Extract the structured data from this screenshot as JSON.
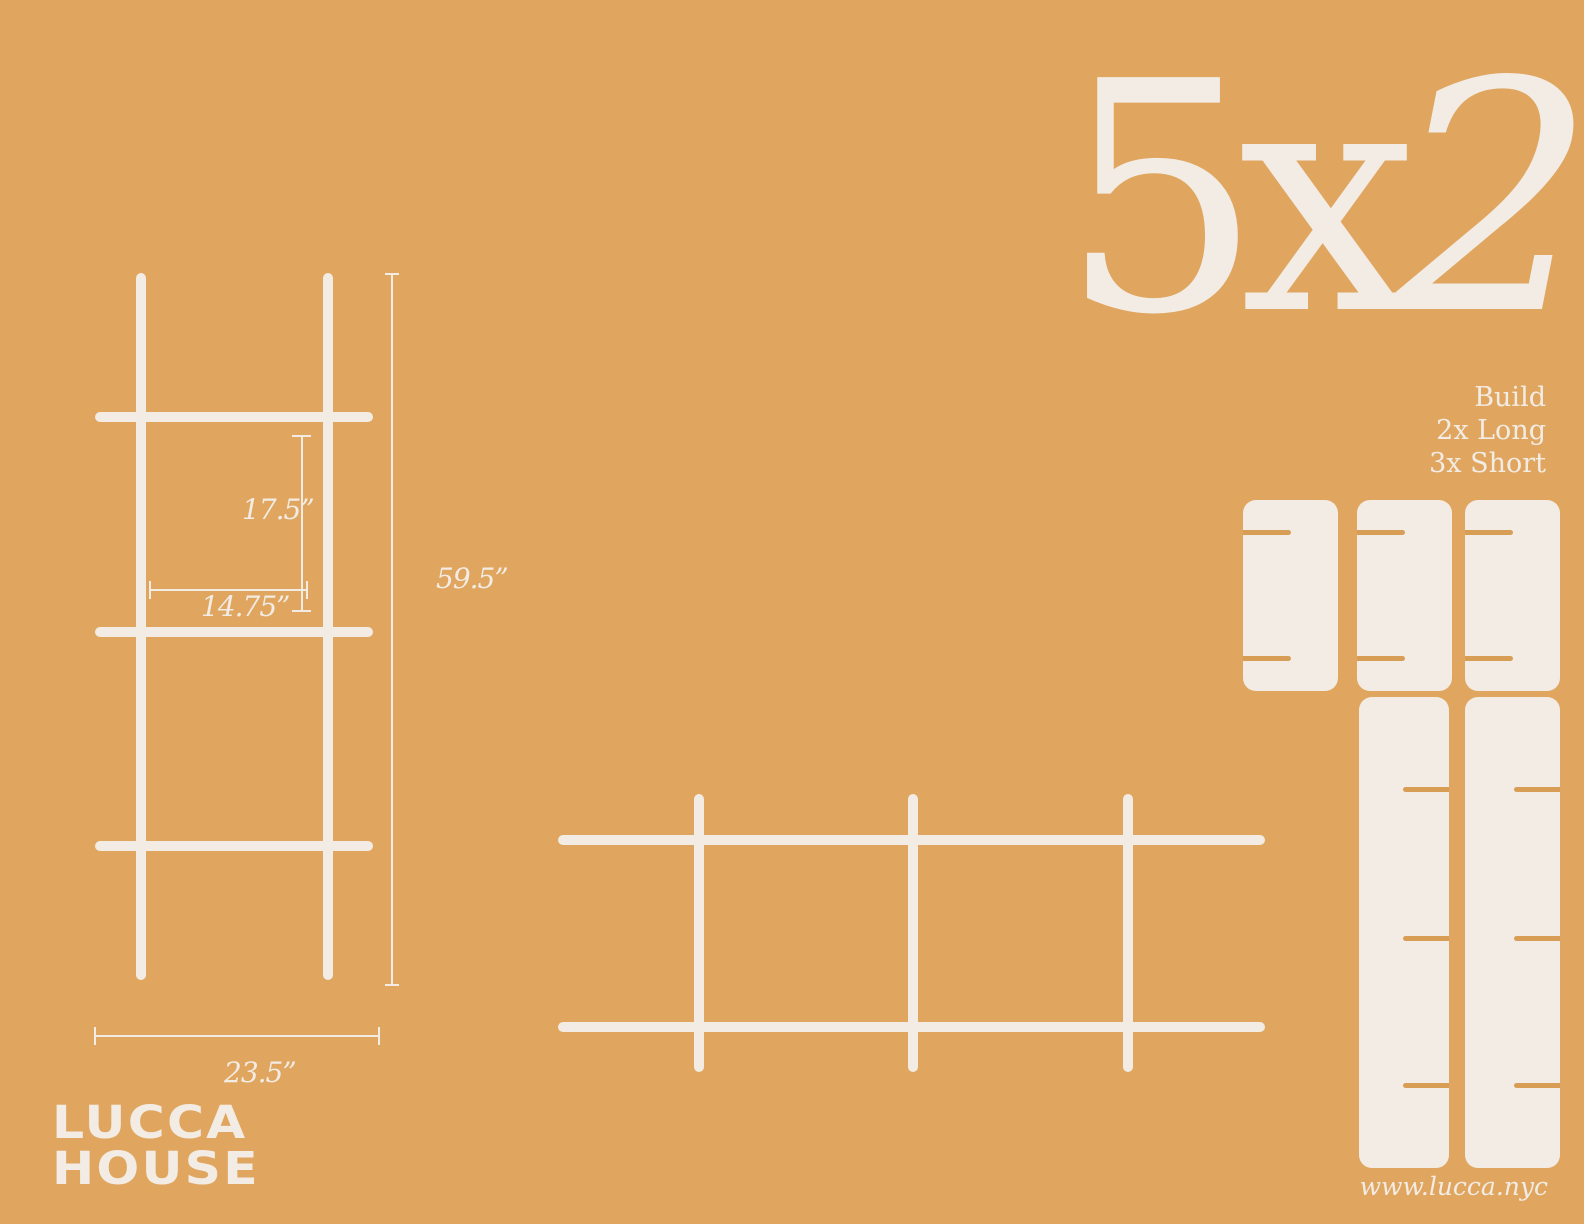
{
  "colors": {
    "bg": "#E0A660",
    "fg": "#F2ECE4",
    "slot": "#D99E56"
  },
  "title": {
    "text": "5x2",
    "chars": [
      "5",
      "x",
      "2"
    ]
  },
  "build_note": {
    "lines": [
      "Build",
      "2x Long",
      "3x Short"
    ]
  },
  "dimensions": {
    "opening_height": "17.5”",
    "opening_width": "14.75”",
    "total_height": "59.5”",
    "total_width": "23.5”"
  },
  "cut_sheet": {
    "short_panels": 3,
    "long_panels": 2
  },
  "logo": {
    "line1": "LUCCA",
    "line2": "HOUSE"
  },
  "website": "www.lucca.nyc"
}
